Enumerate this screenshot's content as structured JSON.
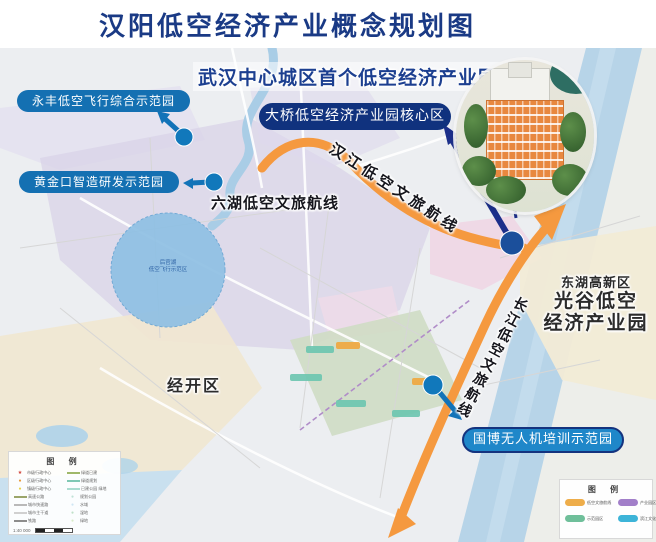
{
  "title": "汉阳低空经济产业概念规划图",
  "banner": "武汉中心城区首个低空经济产业园",
  "labels": {
    "core": "大桥低空经济产业园核心区",
    "yongfeng": "永丰低空飞行综合示范园",
    "huangjinkou": "黄金口智造研发示范园",
    "guobo": "国博无人机培训示范园",
    "zhiyin": "知音文化旅游区",
    "liuhu_route": "六湖低空文旅航线",
    "hanjiang_route": "汉江低空文旅航线",
    "changjiang_route": "长江低空文旅航线",
    "donghu": "东湖高新区",
    "guanggu_line1": "光谷低空",
    "guanggu_line2": "经济产业园",
    "jingkai": "经开区",
    "lake_line1": "后官湖",
    "lake_line2": "低空飞行示范区"
  },
  "colors": {
    "route_orange": "#f5993f",
    "navy": "#1c2f8a",
    "dot_blue": "#1178bb",
    "pill_blue": "#1470b2",
    "pill_navy": "#10327e"
  },
  "legend_left": {
    "title": "图  例",
    "col1": [
      {
        "mark": "★",
        "color": "#d04038",
        "label": "市级行政中心"
      },
      {
        "mark": "●",
        "color": "#e89a3c",
        "label": "区级行政中心"
      },
      {
        "mark": "●",
        "color": "#e8d24a",
        "label": "镇级行政中心"
      },
      {
        "line": "#9aa56a",
        "label": "高速公路"
      },
      {
        "line": "#b9b9b9",
        "label": "城市快速路"
      },
      {
        "line": "#d0d0d0",
        "label": "城市主干道"
      },
      {
        "line": "#8c8c8c",
        "label": "铁路"
      }
    ],
    "col2": [
      {
        "line": "#9fb86a",
        "label": "绿道已建"
      },
      {
        "line": "#7fc8b4",
        "label": "绿道规划"
      },
      {
        "line": "#aadcd0",
        "label": "已建公园 绿地"
      },
      {
        "mark": "●",
        "color": "#bfe2d6",
        "label": "规划公园"
      },
      {
        "mark": "●",
        "color": "#cfe6f4",
        "label": "水域"
      },
      {
        "mark": "●",
        "color": "#bfe0c8",
        "label": "湿地"
      },
      {
        "mark": "●",
        "color": "#d8ecc8",
        "label": "绿地"
      }
    ],
    "scale": "1:40 000"
  },
  "legend_right": {
    "title": "图  例",
    "items": [
      {
        "color": "#eead4a",
        "label": "低空文旅航线"
      },
      {
        "color": "#a27fc9",
        "label": "产业园区"
      },
      {
        "color": "#6fbf9a",
        "label": "示范园区"
      },
      {
        "color": "#3db4d8",
        "label": "滨江文化旅游区"
      }
    ]
  }
}
